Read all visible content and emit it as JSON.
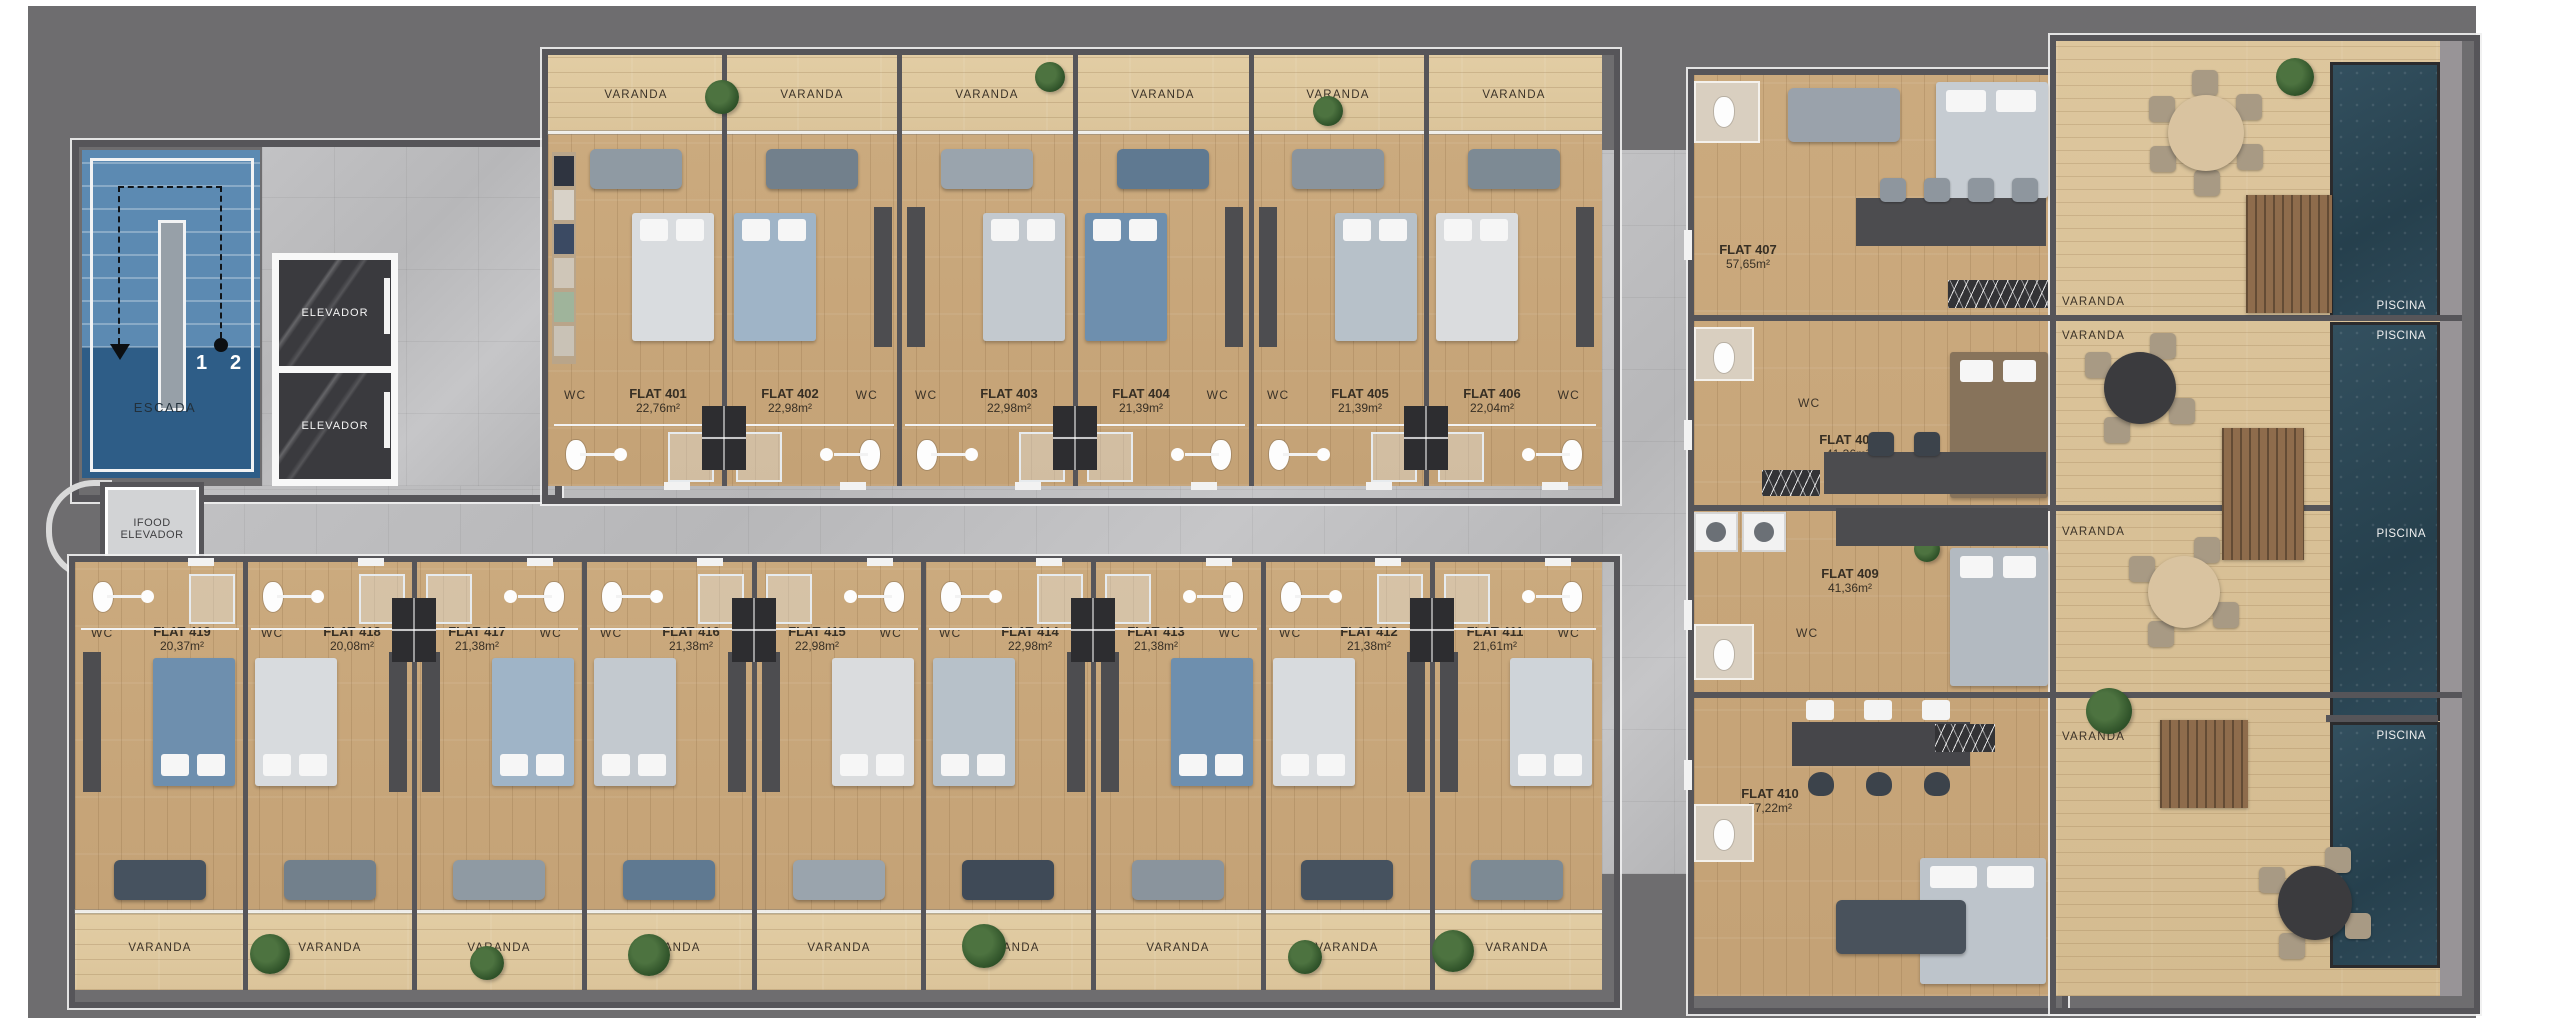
{
  "colors": {
    "canvas": "#6e6d6f",
    "corridor_concrete": "#bdbdbf",
    "flat_wood": "#c8a77b",
    "varanda_wood": "#e0cba2",
    "deck_wood": "#d8c096",
    "pool_water": "#2c4856",
    "stairs_blue_light": "#5c8ab2",
    "stairs_blue_dark": "#2e5d87",
    "wall_gray": "#565559",
    "elevator_marble": "#3a3a3e"
  },
  "core": {
    "escada_label": "ESCADA",
    "stair_number_1": "1",
    "stair_number_2": "2",
    "elevator_1": "ELEVADOR",
    "elevator_2": "ELEVADOR",
    "service_elevator_line1": "IFOOD",
    "service_elevator_line2": "ELEVADOR"
  },
  "labels": {
    "varanda": "VARANDA",
    "wc": "WC",
    "piscina": "PISCINA"
  },
  "top_flats": [
    {
      "number": "FLAT 401",
      "area": "22,76m²"
    },
    {
      "number": "FLAT 402",
      "area": "22,98m²"
    },
    {
      "number": "FLAT 403",
      "area": "22,98m²"
    },
    {
      "number": "FLAT 404",
      "area": "21,39m²"
    },
    {
      "number": "FLAT 405",
      "area": "21,39m²"
    },
    {
      "number": "FLAT 406",
      "area": "22,04m²"
    }
  ],
  "bottom_flats": [
    {
      "number": "FLAT 419",
      "area": "20,37m²"
    },
    {
      "number": "FLAT 418",
      "area": "20,08m²"
    },
    {
      "number": "FLAT 417",
      "area": "21,38m²"
    },
    {
      "number": "FLAT 416",
      "area": "21,38m²"
    },
    {
      "number": "FLAT 415",
      "area": "22,98m²"
    },
    {
      "number": "FLAT 414",
      "area": "22,98m²"
    },
    {
      "number": "FLAT 413",
      "area": "21,38m²"
    },
    {
      "number": "FLAT 412",
      "area": "21,38m²"
    },
    {
      "number": "FLAT 411",
      "area": "21,61m²"
    }
  ],
  "right_flats": [
    {
      "number": "FLAT 407",
      "area": "57,65m²"
    },
    {
      "number": "FLAT 408",
      "area": "41,36m²"
    },
    {
      "number": "FLAT 409",
      "area": "41,36m²"
    },
    {
      "number": "FLAT 410",
      "area": "57,22m²"
    }
  ]
}
